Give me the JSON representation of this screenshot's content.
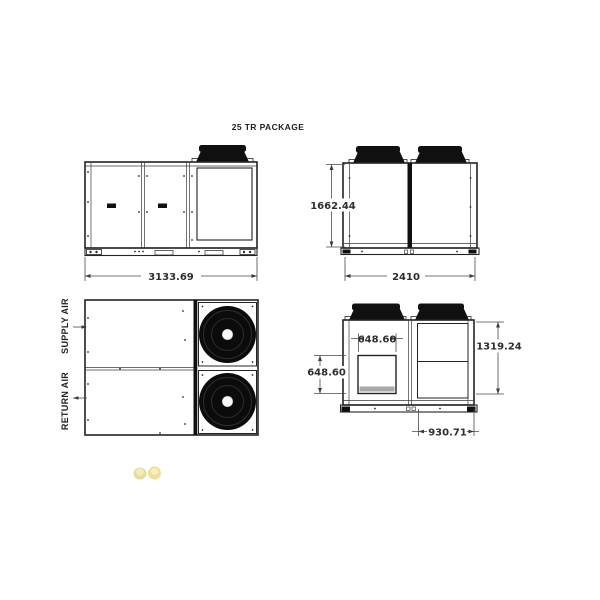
{
  "title": "25 TR PACKAGE",
  "labels": {
    "supply_air": "SUPPLY AIR",
    "return_air": "RETURN AIR"
  },
  "dimensions": {
    "overall_length": "3133.69",
    "overall_height": "1662.44",
    "overall_width": "2410",
    "opening_width": "648.60",
    "opening_height": "648.60",
    "unit_height": "1319.24",
    "condenser_width": "930.71"
  },
  "colors": {
    "background": "#ffffff",
    "line": "#232323",
    "dim_line": "#4a4a4a",
    "text": "#2e2e2e",
    "fill_dark": "#101010",
    "vent_strip": "#a8a8a8",
    "watermark": "#dcc44c"
  }
}
